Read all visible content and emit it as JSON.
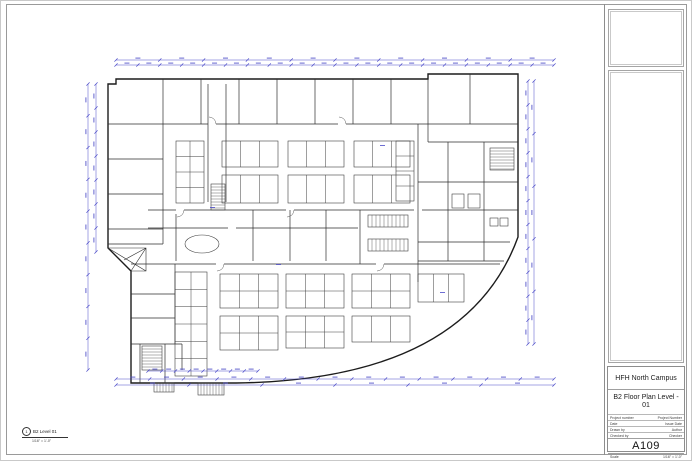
{
  "titleblock": {
    "project_name": "HFH North Campus",
    "sheet_title": "B2 Floor Plan Level - 01",
    "fields": [
      {
        "label": "Project number",
        "value": "Project Number"
      },
      {
        "label": "Date",
        "value": "Issue Date"
      },
      {
        "label": "Drawn by",
        "value": "Author"
      },
      {
        "label": "Checked by",
        "value": "Checker"
      }
    ],
    "sheet_number": "A109",
    "scale_label": "Scale",
    "scale_value": "1/16\" = 1'-0\""
  },
  "view_title": {
    "detail_number": "1",
    "view_name": "B2 Level 01",
    "view_scale": "1/16\" = 1'-0\""
  },
  "drawing": {
    "type": "architectural-floor-plan",
    "wall_color": "#1c1c1c",
    "partition_color": "#2e2e2e",
    "furniture_color": "#3e3e3e",
    "dimension_color": "#4a4ac8"
  }
}
